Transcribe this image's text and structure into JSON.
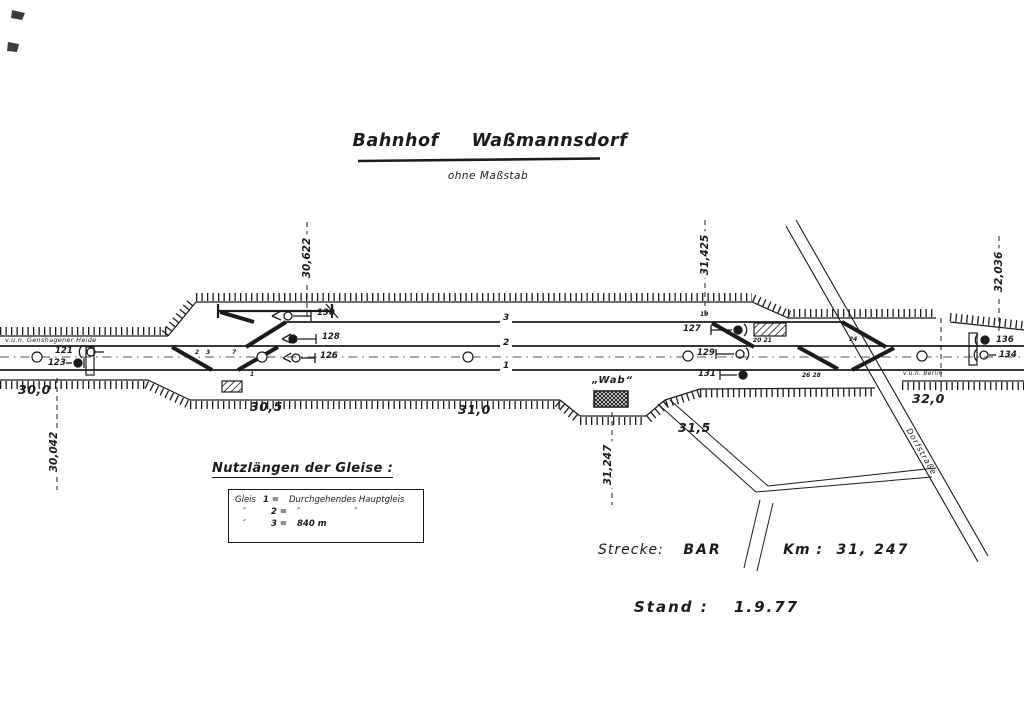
{
  "title": "Bahnhof  Waßmannsdorf",
  "subtitle": "ohne Maßstab",
  "legend": {
    "heading": "Nutzlängen der Gleise :",
    "rows": [
      {
        "gleis": "Gleis",
        "num": "1 =",
        "value": "Durchgehendes Hauptgleis"
      },
      {
        "gleis": "″",
        "num": "2 =",
        "value": "″                    ″"
      },
      {
        "gleis": "″",
        "num": "3 =",
        "value": "840 m"
      }
    ]
  },
  "route_info": {
    "strecke_label": "Strecke:",
    "strecke_value": "BAR",
    "km_label": "Km :",
    "km_value": "31, 247"
  },
  "stand_info": {
    "label": "Stand :",
    "value": "1.9.77"
  },
  "directions": {
    "left": "v.u.n. Genshagener Heide",
    "right": "v.u.n. Berlin"
  },
  "buildings": {
    "station": "„Wab“"
  },
  "road": {
    "name": "Dorfstraße"
  },
  "tracks": {
    "t3": "3",
    "t2": "2",
    "t1": "1"
  },
  "km_marks": [
    {
      "text": "30,0"
    },
    {
      "text": "30,5"
    },
    {
      "text": "31,0"
    },
    {
      "text": "31,5"
    },
    {
      "text": "32,0"
    }
  ],
  "chainages": {
    "left_top": "30,622",
    "mid_top": "31,425",
    "right_top": "32,036",
    "left_bottom": "30,042",
    "mid_bottom": "31,247"
  },
  "signals": {
    "s121": "121",
    "s123": "123",
    "s126": "126",
    "s128": "128",
    "s130": "130",
    "s127": "127",
    "s129": "129",
    "s131": "131",
    "s134": "134",
    "s136": "136"
  },
  "points": {
    "p2": "2",
    "p3": "3",
    "p7": "7",
    "p1": "1",
    "p19": "19",
    "p2021": "20 21",
    "p24": "24",
    "p2628": "26 28"
  },
  "colors": {
    "ink": "#1b1b1b",
    "paper": "#ffffff"
  }
}
